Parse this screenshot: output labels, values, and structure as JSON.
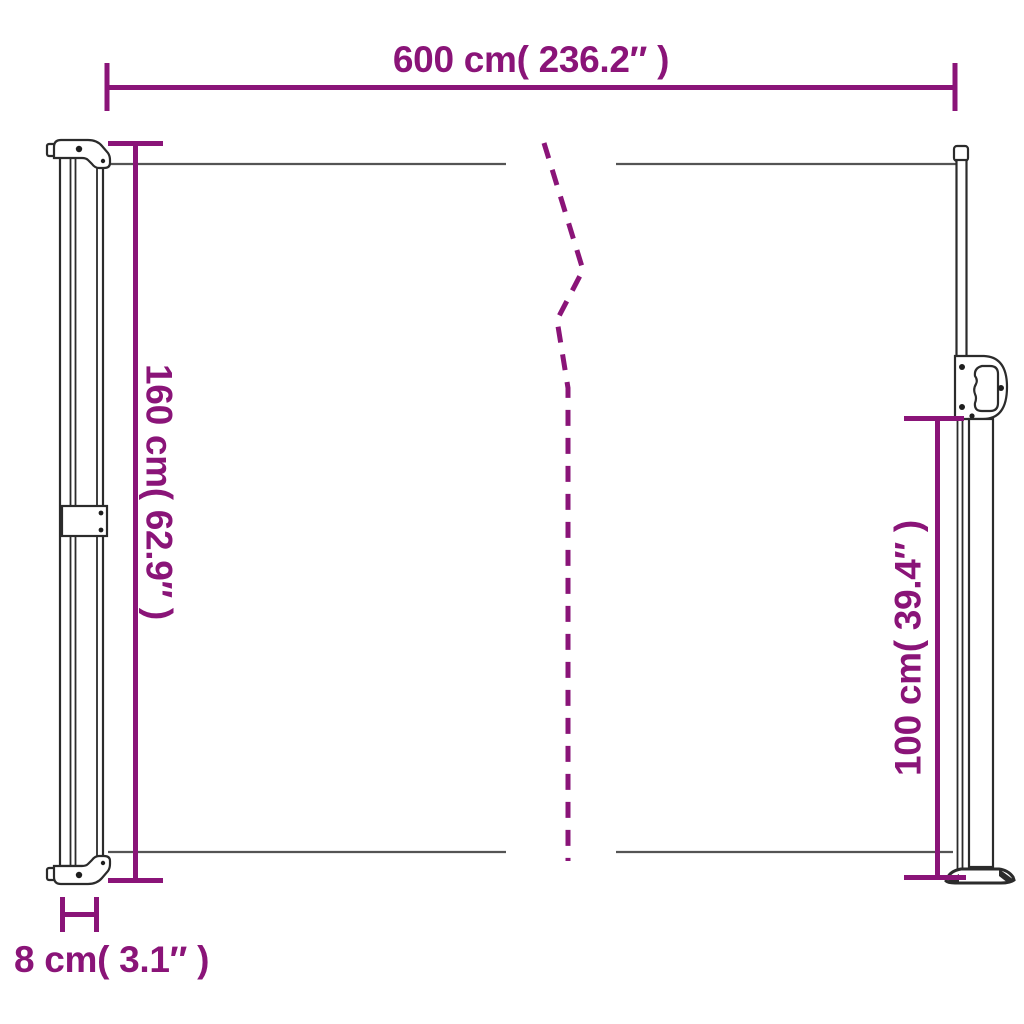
{
  "colors": {
    "accent": "#8A1478",
    "fabric": "#545454",
    "frame": "#2B2B2B",
    "background": "#FFFFFF"
  },
  "dimensions": {
    "awning_width": {
      "cm": 600,
      "inch": 236.2,
      "label": "600 cm( 236.2″ )"
    },
    "cassette_height": {
      "cm": 160,
      "inch": 62.9,
      "label": "160 cm( 62.9″ )"
    },
    "pole_height": {
      "cm": 100,
      "inch": 39.4,
      "label": "100 cm( 39.4″ )"
    },
    "cassette_depth": {
      "cm": 8,
      "inch": 3.1,
      "label": "8 cm( 3.1″ )"
    }
  }
}
